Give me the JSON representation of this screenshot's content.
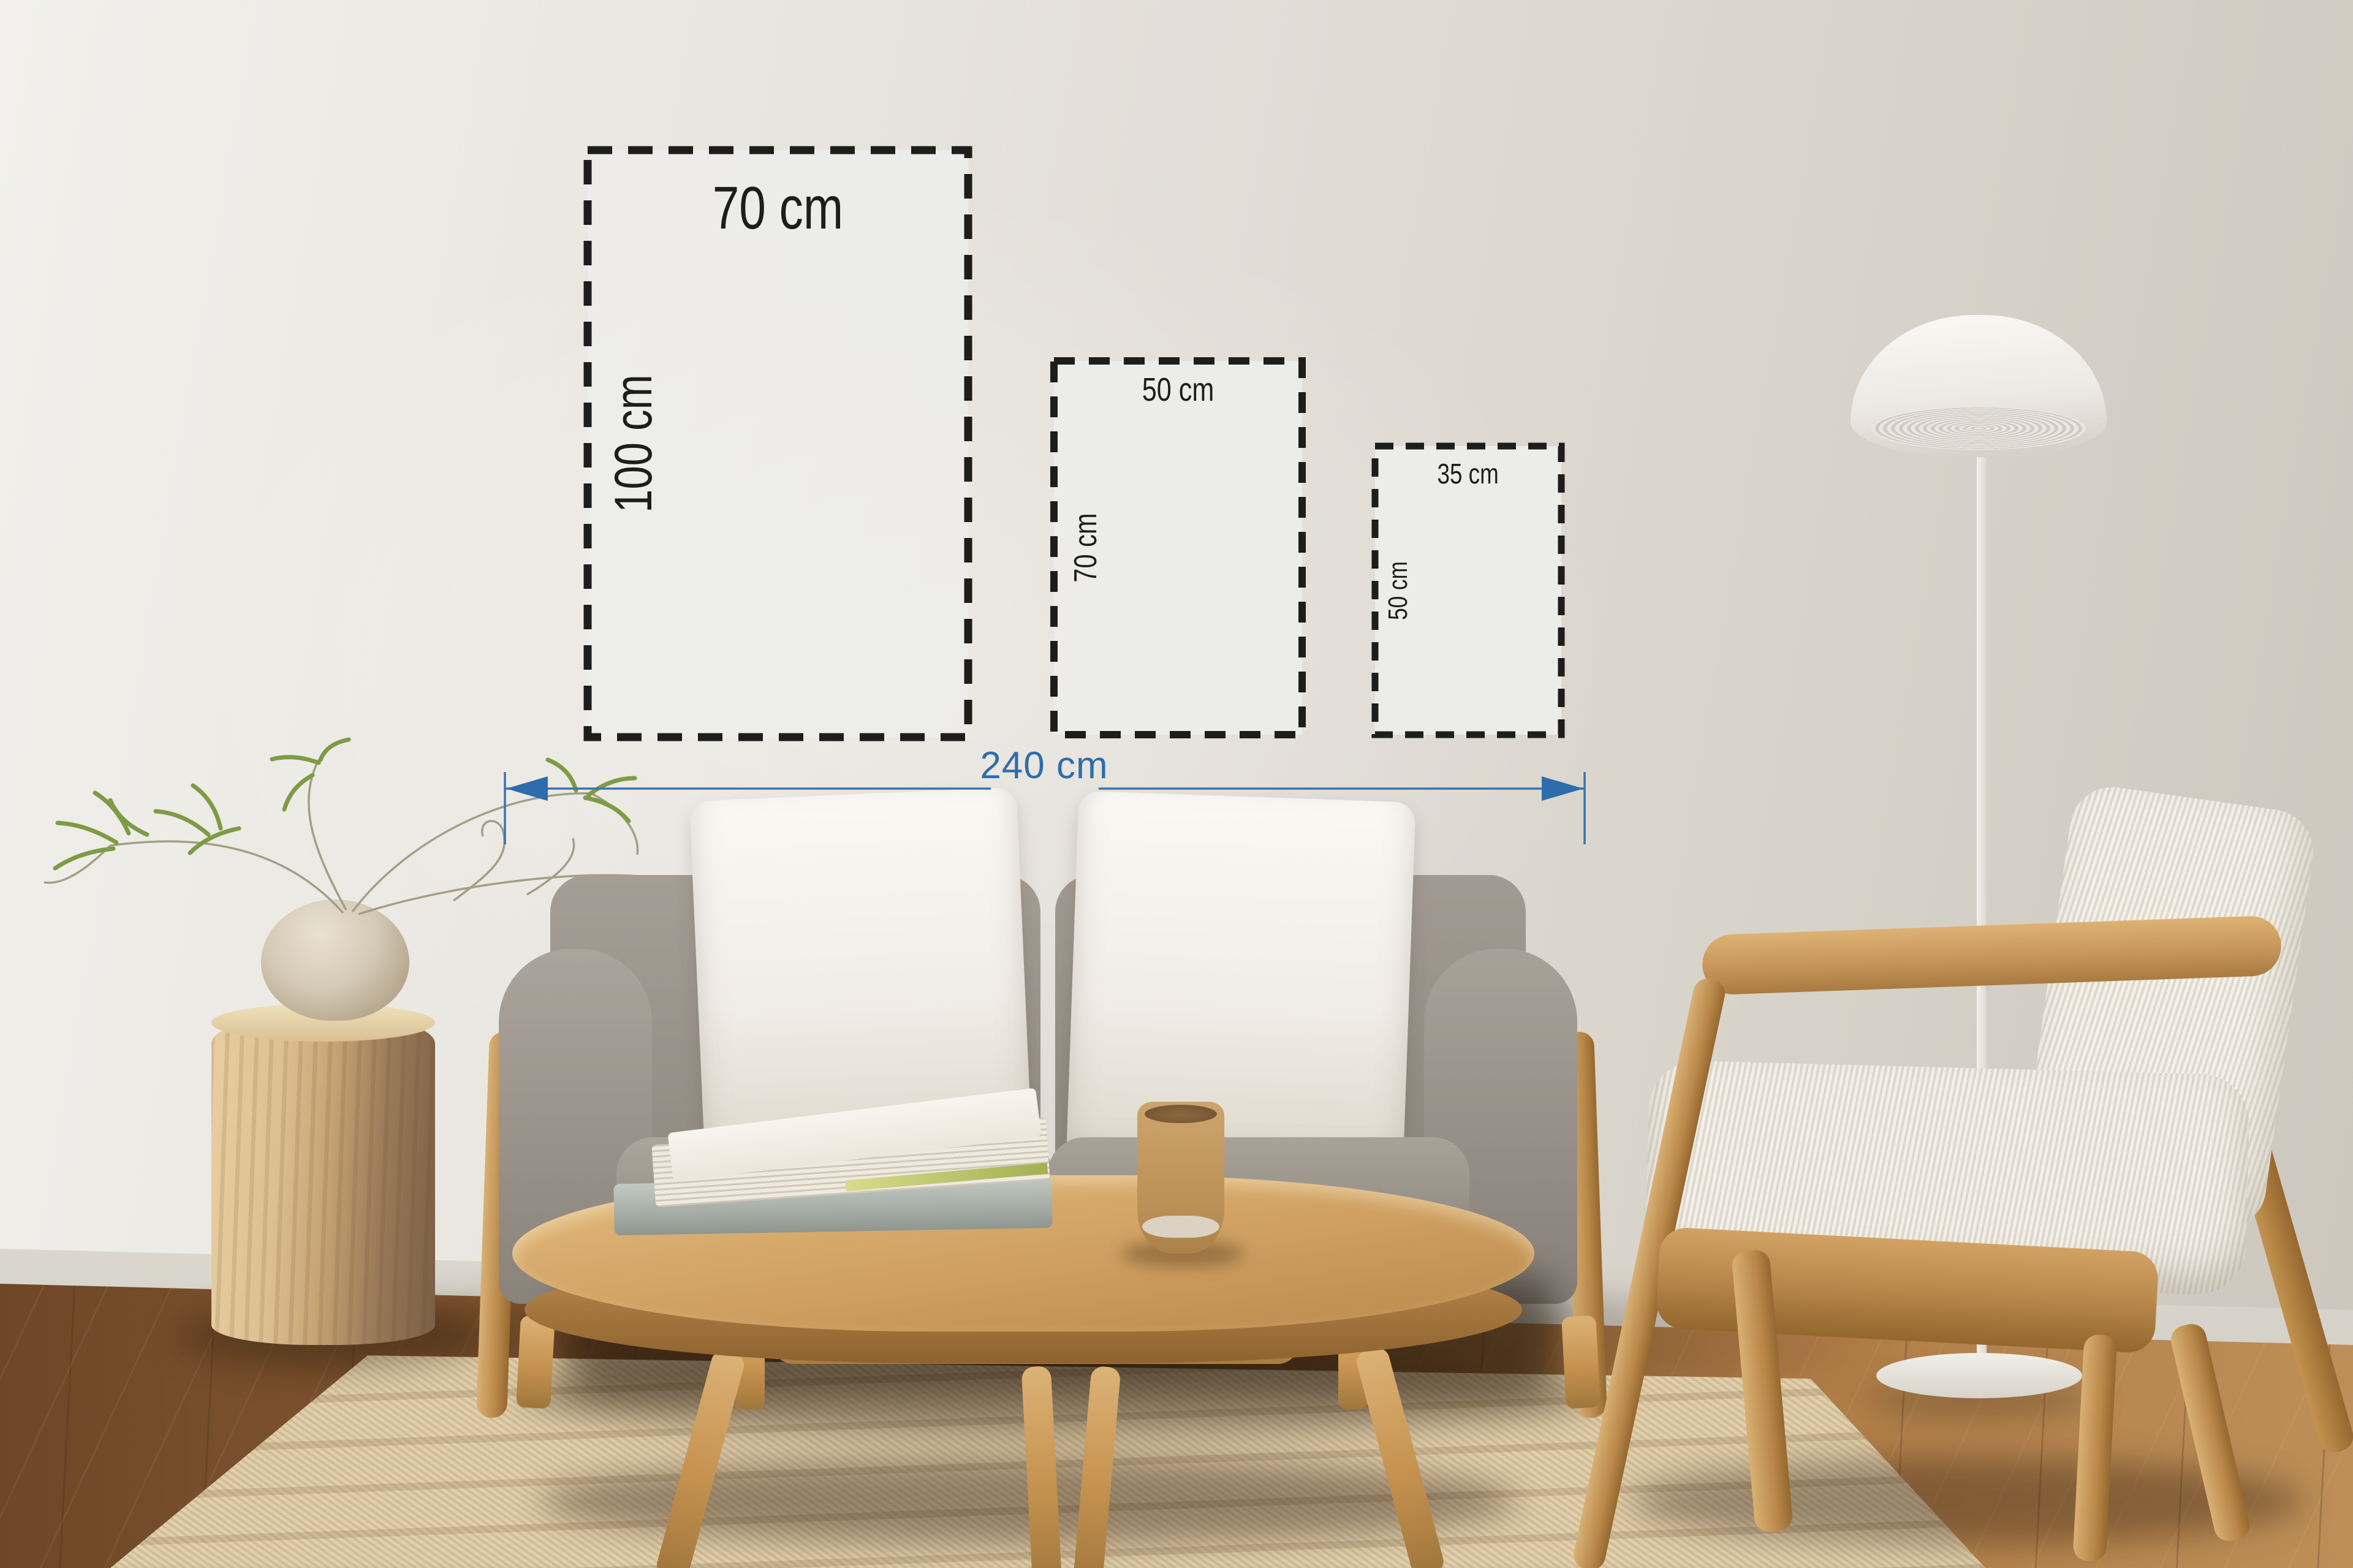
{
  "overlay": {
    "frames": [
      {
        "width_label": "70 cm",
        "height_label": "100 cm"
      },
      {
        "width_label": "50 cm",
        "height_label": "70 cm"
      },
      {
        "width_label": "35 cm",
        "height_label": "50 cm"
      }
    ],
    "wall_width": {
      "label": "240 cm"
    }
  },
  "colors": {
    "dimension_blue": "#2e6dab",
    "dash_black": "#1d1d1b",
    "frame_fill": "#ececea",
    "wall": "#e2dfd7",
    "floor_wood": "#9c6b3e",
    "rug_beige": "#d9c5a0",
    "sofa_gray": "#98918a",
    "pillow_white": "#f4f2ec",
    "oak_wood": "#c6985c",
    "lamp_white": "#f1efe9",
    "plant_green": "#7d9c45"
  }
}
